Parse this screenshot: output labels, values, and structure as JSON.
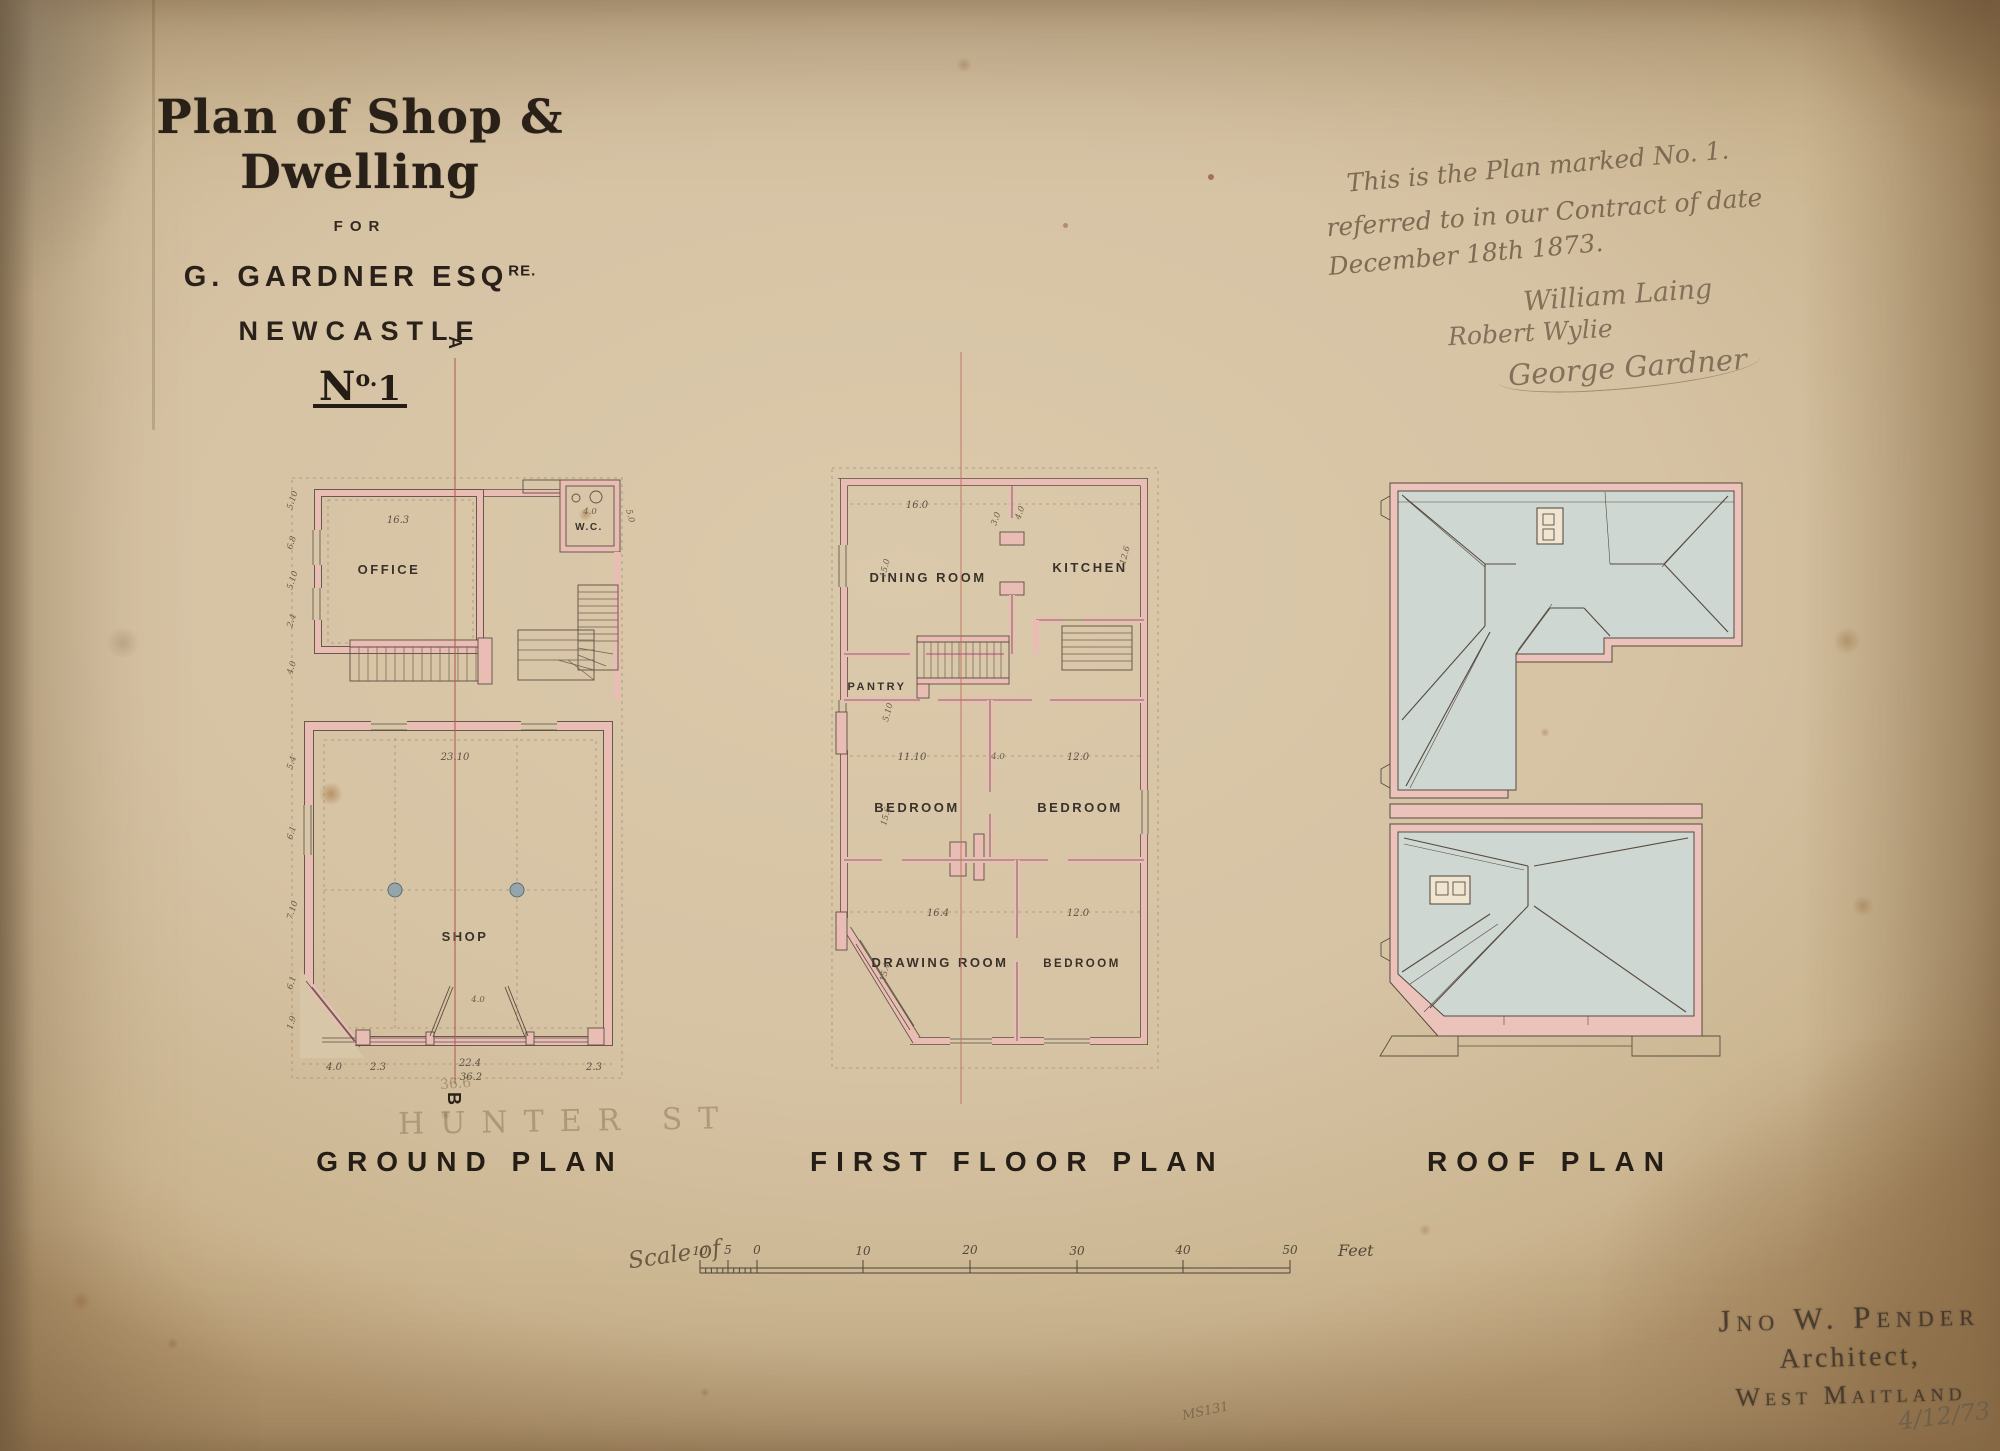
{
  "title_block": {
    "title": "Plan of Shop & Dwelling",
    "for_label": "FOR",
    "client": "G. GARDNER ESQ",
    "client_sup": "RE.",
    "city": "NEWCASTLE",
    "no_n": "N",
    "no_o": "o.",
    "no_value": "1"
  },
  "note": {
    "line1": "This is the Plan marked No. 1.",
    "line2": "referred to in our Contract of date",
    "line3": "December 18th 1873.",
    "sig1": "William Laing",
    "sig2": "Robert Wylie",
    "sig3": "George Gardner"
  },
  "ground": {
    "title": "GROUND PLAN",
    "office": "OFFICE",
    "wc": "W.C.",
    "shop": "SHOP",
    "dim_office": "16.3",
    "dim_wc": "4.0",
    "dim_wc_side": "5.0",
    "dim_shop": "23.10",
    "door_dim": "4.0",
    "front_dims": [
      "4.0",
      "2.3",
      "22.4",
      "36.2",
      "2.3"
    ],
    "side_dims": [
      "5.10",
      "6.8",
      "5.10",
      "2.4",
      "4.0",
      "5.4",
      "6.1",
      "7.10",
      "6.1",
      "1.9"
    ],
    "pencil_street": "HUNTER ST",
    "pencil_dim": "36.6",
    "marker_a": "A",
    "marker_b": "B"
  },
  "first": {
    "title": "FIRST FLOOR PLAN",
    "dining": "DINING ROOM",
    "kitchen": "KITCHEN",
    "pantry": "PANTRY",
    "bedroom1": "BEDROOM",
    "bedroom2": "BEDROOM",
    "drawing": "DRAWING ROOM",
    "bedroom3": "BEDROOM",
    "dim_dining_w": "16.0",
    "dim_dining_h": "15.0",
    "dim_kitchen_h": "12.6",
    "dim_lobby1": "3.0",
    "dim_lobby2": "4.0",
    "dim_pantry": "5.10",
    "dim_bed1_w": "11.10",
    "dim_hall": "4.0",
    "dim_bed2_w": "12.0",
    "dim_bed1_h": "15.6",
    "dim_drawing_w": "16.4",
    "dim_bed3_w": "12.0",
    "dim_drawing_h": "15.4"
  },
  "roof": {
    "title": "ROOF PLAN"
  },
  "scale_bar": {
    "label": "Scale of",
    "ticks": [
      "10",
      "5",
      "0",
      "10",
      "20",
      "30",
      "40",
      "50"
    ],
    "unit": "Feet"
  },
  "stamp": {
    "name": "Jno W. Pender",
    "role": "Architect,",
    "place": "West Maitland",
    "date": "4/12/73"
  },
  "catalog": "MS131",
  "colors": {
    "paper": "#d8c6a8",
    "wall_pink": "#e9bdb4",
    "roof_wash": "#cfd7d2",
    "ink": "#2a221a",
    "section_red": "#b25e52",
    "handwriting": "#7d6b53"
  }
}
